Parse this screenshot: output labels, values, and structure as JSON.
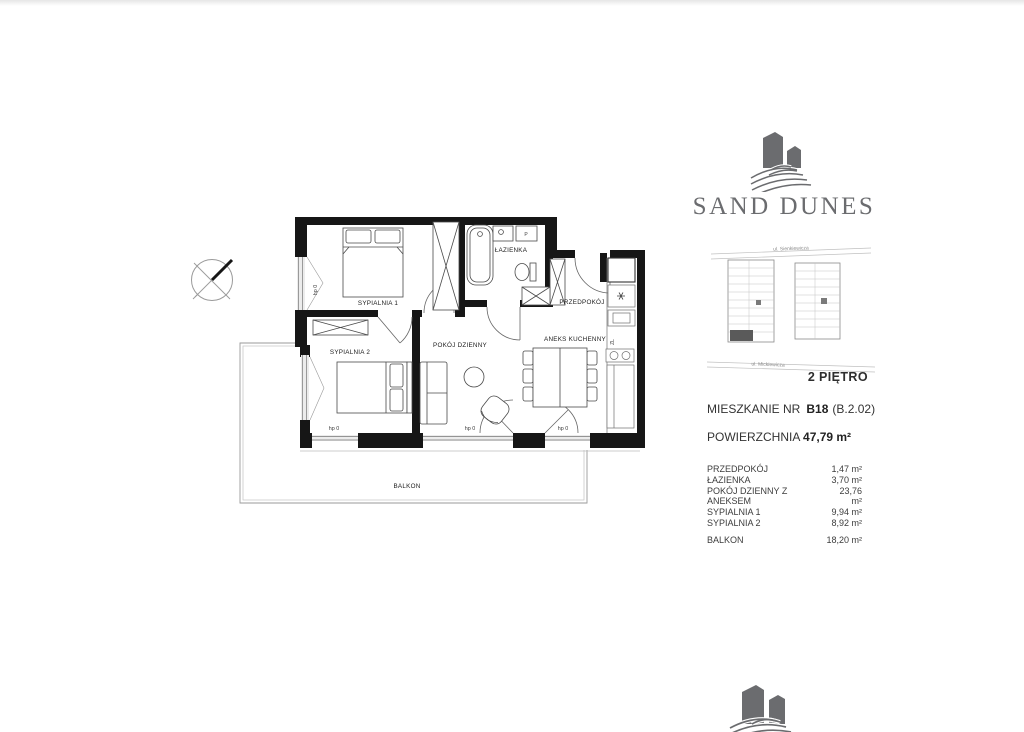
{
  "brand": {
    "name": "SAND DUNES"
  },
  "site_plan": {
    "street_top": "ul. Sienkiewicza",
    "street_bottom": "ul. Mickiewicza",
    "floor_label": "2 PIĘTRO"
  },
  "apartment": {
    "label": "MIESZKANIE NR",
    "number": "B18",
    "code": "(B.2.02)",
    "area_label": "POWIERZCHNIA",
    "area_value": "47,79 m²"
  },
  "room_list": [
    {
      "name": "PRZEDPOKÓJ",
      "area": "1,47 m²"
    },
    {
      "name": "ŁAZIENKA",
      "area": "3,70 m²"
    },
    {
      "name": "POKÓJ DZIENNY Z ANEKSEM",
      "area": "23,76 m²"
    },
    {
      "name": "SYPIALNIA 1",
      "area": "9,94 m²"
    },
    {
      "name": "SYPIALNIA 2",
      "area": "8,92 m²"
    }
  ],
  "balcony_row": {
    "name": "BALKON",
    "area": "18,20 m²"
  },
  "plan": {
    "labels": {
      "sypialnia1": "SYPIALNIA 1",
      "sypialnia2": "SYPIALNIA 2",
      "pokoj_dzienny": "POKÓJ DZIENNY",
      "aneks_kuchenny": "ANEKS KUCHENNY",
      "lazienka": "ŁAZIENKA",
      "przedpokoj": "PRZEDPOKÓJ",
      "balkon": "BALKON",
      "hp0": "hp 0",
      "washer": "P",
      "sink_unit": "ZL"
    }
  },
  "colors": {
    "ink": "#161616",
    "logo_gray": "#6b6c6f",
    "line_gray": "#999999"
  }
}
